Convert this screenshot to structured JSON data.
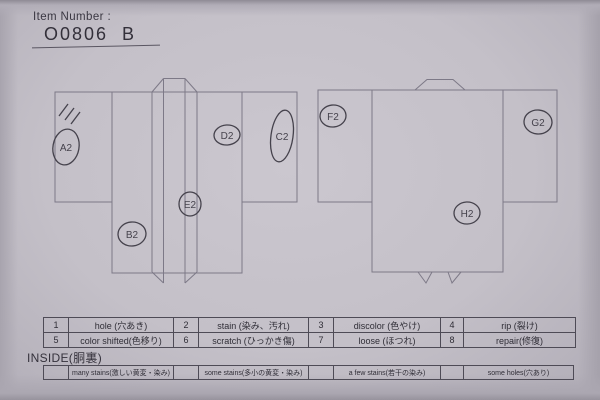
{
  "header": {
    "label": "Item Number :",
    "value": "O0806  B"
  },
  "colors": {
    "paper": "#c6c2ca",
    "ink": "#45424c",
    "outline": "#7d7987"
  },
  "markers": {
    "a2": "A2",
    "b2": "B2",
    "c2": "C2",
    "d2": "D2",
    "e2": "E2",
    "f2": "F2",
    "g2": "G2",
    "h2": "H2"
  },
  "defect_table": {
    "rows": [
      {
        "cells": [
          {
            "num": "1",
            "label": "hole (穴あき)"
          },
          {
            "num": "2",
            "label": "stain (染み、汚れ)"
          },
          {
            "num": "3",
            "label": "discolor (色やけ)"
          },
          {
            "num": "4",
            "label": "rip (裂け)"
          }
        ]
      },
      {
        "cells": [
          {
            "num": "5",
            "label": "color shifted(色移り)"
          },
          {
            "num": "6",
            "label": "scratch (ひっかき傷)"
          },
          {
            "num": "7",
            "label": "loose (ほつれ)"
          },
          {
            "num": "8",
            "label": "repair(修復)"
          }
        ]
      }
    ]
  },
  "inside": {
    "title": "INSIDE(胴裏)",
    "options": [
      "many stains(激しい黄変・染み)",
      "some stains(多小の黄変・染み)",
      "a few stains(若干の染み)",
      "some holes(穴あり)"
    ]
  }
}
